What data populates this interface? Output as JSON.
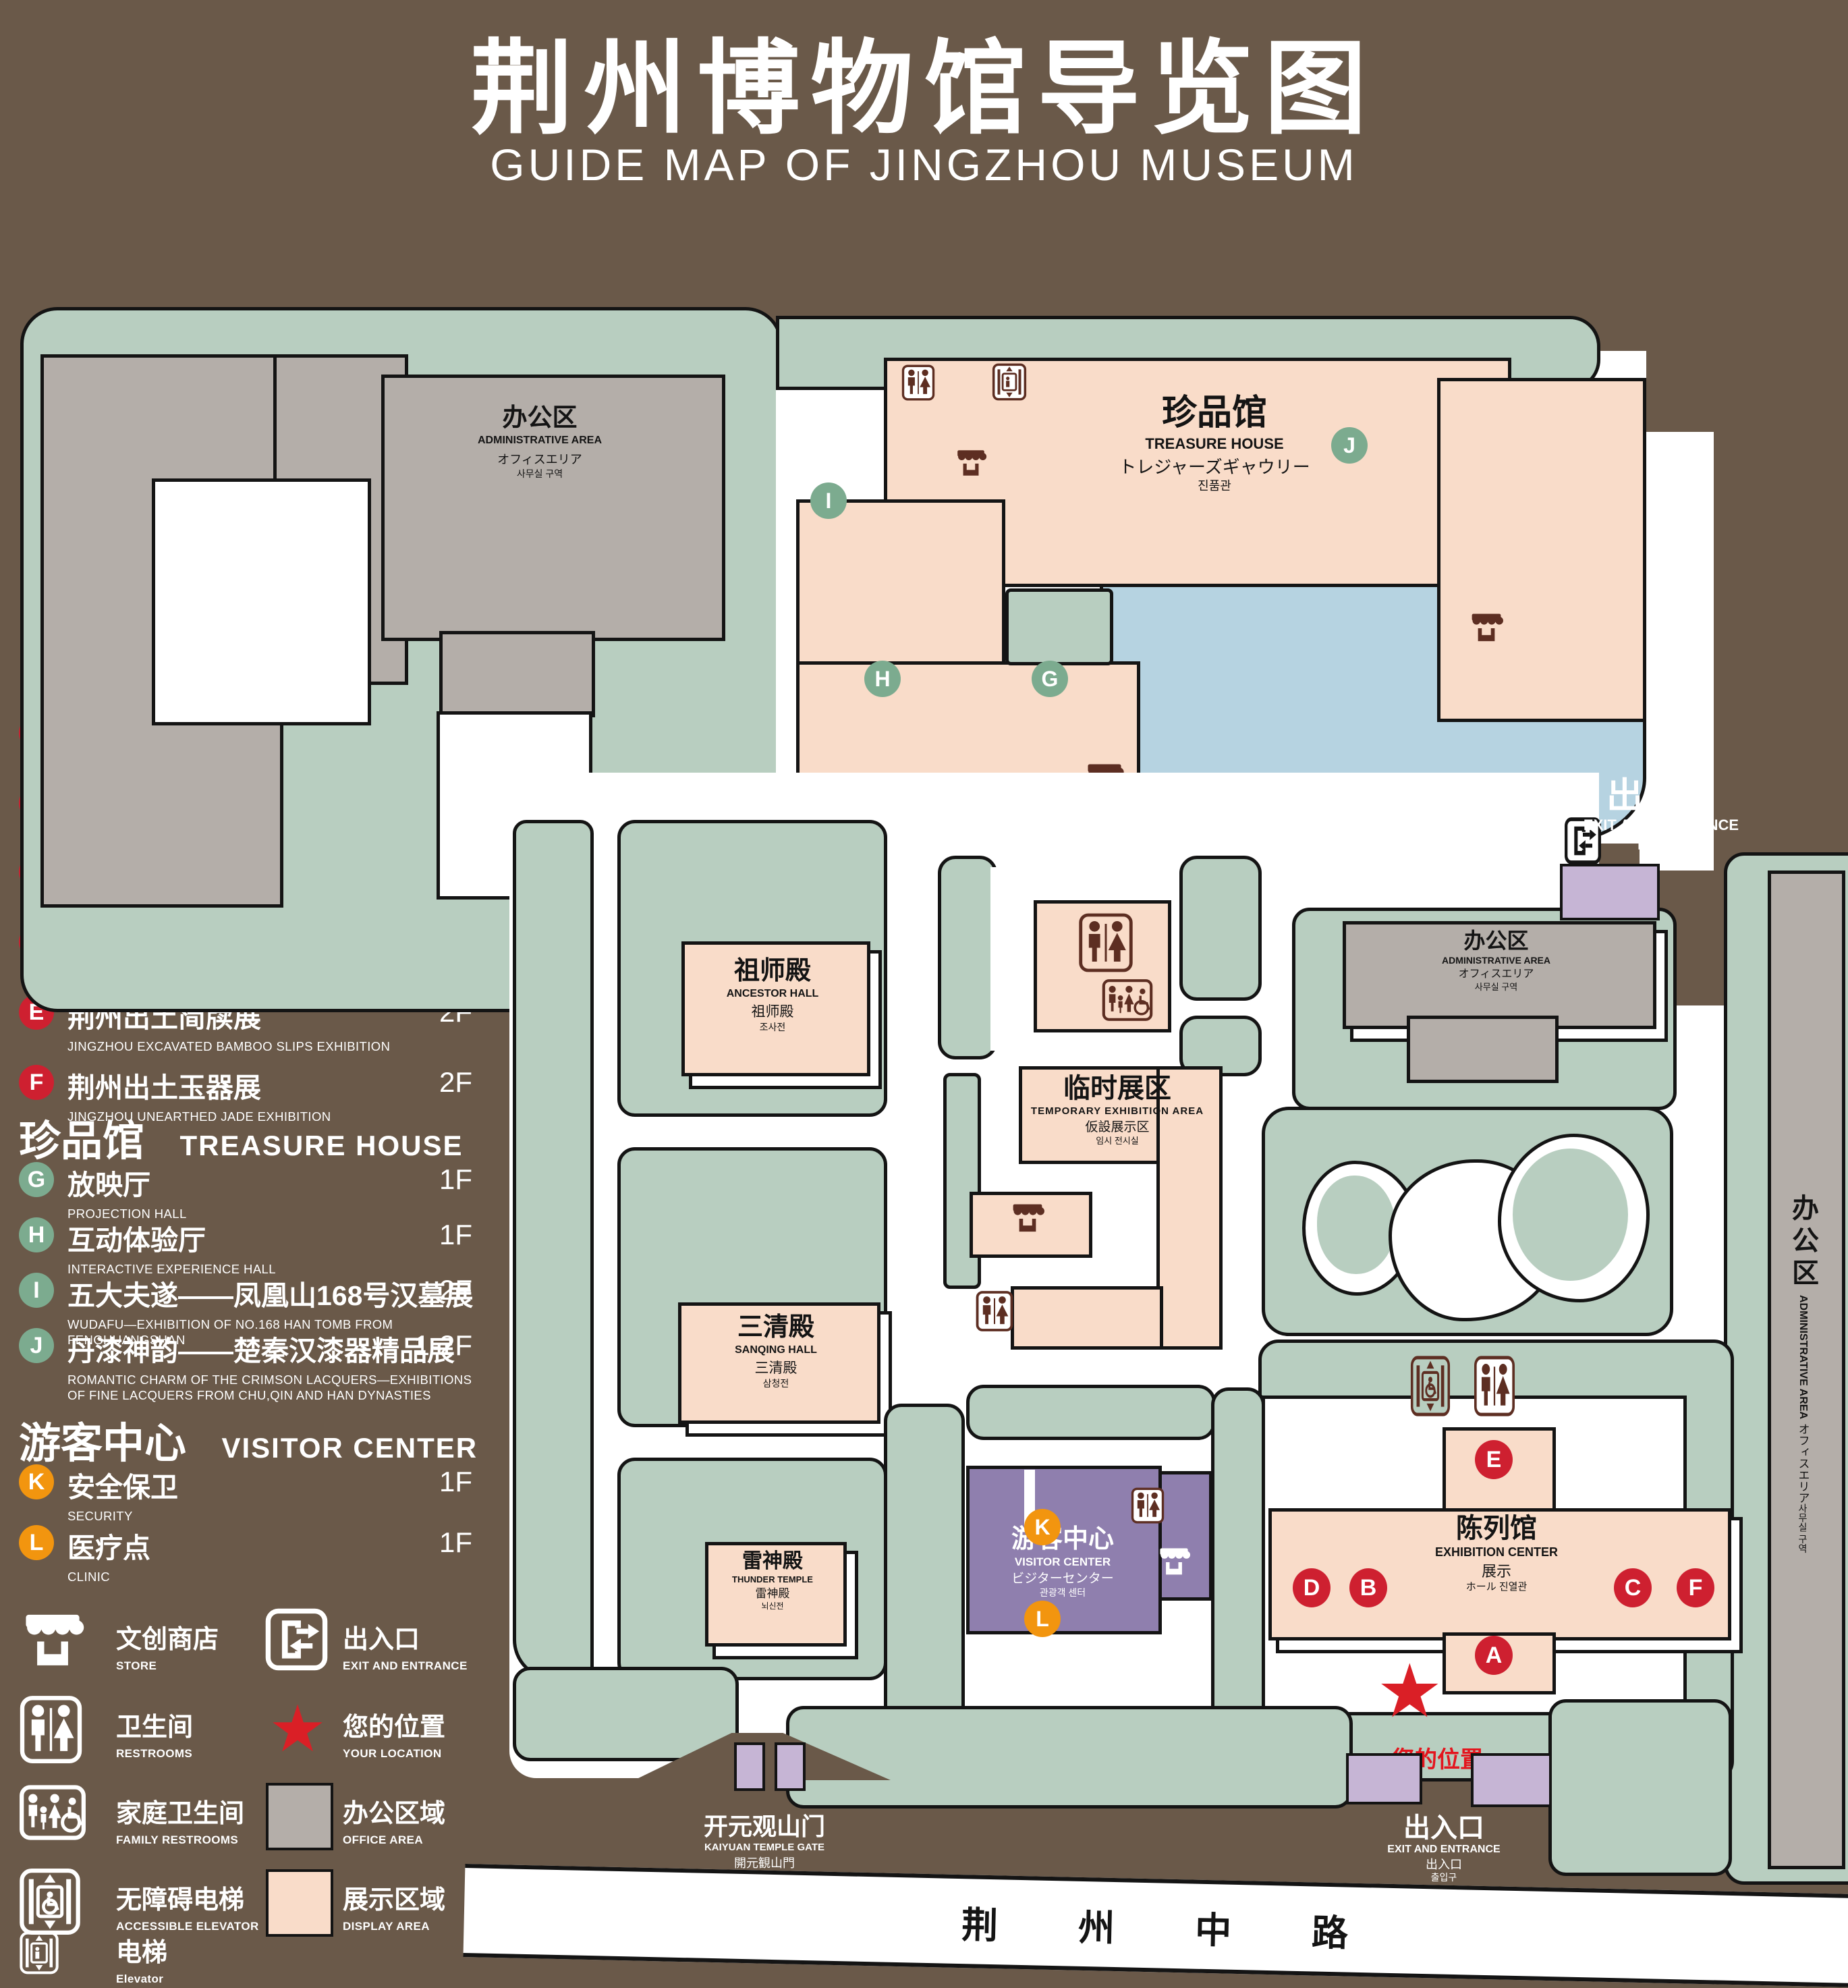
{
  "title": {
    "zh": "荆州博物馆导览图",
    "en": "GUIDE MAP OF JINGZHOU MUSEUM"
  },
  "legend": {
    "sections": [
      {
        "zh": "陈列馆",
        "en": "EXHIBITION CENTER",
        "items": [
          {
            "id": "A",
            "zh": "《火中的凤凰》壁画",
            "en": "THE PHOENIX IN FIRE \"MURAL PAINTING",
            "floor": "1F"
          },
          {
            "id": "B",
            "zh": "荆州出土铜器展",
            "en": "JINGZHOU UNEARTHED BRONZE WARE EXHIBITION",
            "floor": "1F"
          },
          {
            "id": "C",
            "zh": "江汉平原原始文化展",
            "en": "JIANGHAN PLAIN PRIMITIVE CULTURE EXHIBITION",
            "floor": "1F"
          },
          {
            "id": "D",
            "zh": "荆州出土瓷器展",
            "en": "JINGZHOU UNEARTHED PORCELAIN EXHIBITIONE",
            "floor": "2F"
          },
          {
            "id": "E",
            "zh": "荆州出土简牍展",
            "en": "JINGZHOU EXCAVATED BAMBOO SLIPS EXHIBITION",
            "floor": "2F"
          },
          {
            "id": "F",
            "zh": "荆州出土玉器展",
            "en": "JINGZHOU UNEARTHED JADE EXHIBITION",
            "floor": "2F"
          }
        ]
      },
      {
        "zh": "珍品馆",
        "en": "TREASURE HOUSE",
        "items": [
          {
            "id": "G",
            "zh": "放映厅",
            "en": "PROJECTION HALL",
            "floor": "1F"
          },
          {
            "id": "H",
            "zh": "互动体验厅",
            "en": "INTERACTIVE EXPERIENCE HALL",
            "floor": "1F"
          },
          {
            "id": "I",
            "zh": "五大夫遂——凤凰山168号汉墓展",
            "en": "WUDAFU—EXHIBITION OF NO.168 HAN TOMB FROM FENGHUANGSHAN",
            "floor": "2F"
          },
          {
            "id": "J",
            "zh": "丹漆神韵——楚秦汉漆器精品展",
            "en": "ROMANTIC CHARM OF THE CRIMSON LACQUERS—EXHIBITIONS OF FINE LACQUERS FROM CHU,QIN AND HAN DYNASTIES",
            "floor": "1-2F"
          }
        ]
      },
      {
        "zh": "游客中心",
        "en": "VISITOR CENTER",
        "items": [
          {
            "id": "K",
            "zh": "安全保卫",
            "en": "SECURITY",
            "floor": "1F"
          },
          {
            "id": "L",
            "zh": "医疗点",
            "en": "CLINIC",
            "floor": "1F"
          }
        ]
      }
    ],
    "symbols": {
      "store": {
        "zh": "文创商店",
        "en": "STORE"
      },
      "exit": {
        "zh": "出入口",
        "en": "EXIT AND ENTRANCE"
      },
      "restroom": {
        "zh": "卫生间",
        "en": "RESTROOMS"
      },
      "location": {
        "zh": "您的位置",
        "en": "YOUR LOCATION"
      },
      "family": {
        "zh": "家庭卫生间",
        "en": "FAMILY RESTROOMS"
      },
      "office": {
        "zh": "办公区域",
        "en": "OFFICE AREA"
      },
      "accessible": {
        "zh": "无障碍电梯",
        "en": "ACCESSIBLE ELEVATOR"
      },
      "display": {
        "zh": "展示区域",
        "en": "DISPLAY AREA"
      },
      "elevator": {
        "zh": "电梯",
        "en": "Elevator"
      }
    }
  },
  "map": {
    "admin": {
      "zh": "办公区",
      "en": "ADMINISTRATIVE AREA",
      "jp": "オフィスエリア",
      "kr": "사무실 구역"
    },
    "treasure": {
      "zh": "珍品馆",
      "en": "TREASURE HOUSE",
      "jp": "トレジャーズギャウリー",
      "kr": "진품관"
    },
    "ancestor": {
      "zh": "祖师殿",
      "en": "ANCESTOR HALL",
      "zh2": "祖师殿",
      "kr": "조사전"
    },
    "sanqing": {
      "zh": "三清殿",
      "en": "SANQING HALL",
      "zh2": "三清殿",
      "kr": "삼청전"
    },
    "thunder": {
      "zh": "雷神殿",
      "en": "THUNDER TEMPLE",
      "zh2": "雷神殿",
      "kr": "뇌신전"
    },
    "temporary": {
      "zh": "临时展区",
      "en": "TEMPORARY EXHIBITION AREA",
      "jp": "仮設展示区",
      "kr": "임시 전시실"
    },
    "visitor": {
      "zh": "游客中心",
      "en": "VISITOR CENTER",
      "jp": "ビジターセンター",
      "kr": "관광객 센터"
    },
    "exhibition": {
      "zh": "陈列馆",
      "en": "EXHIBITION CENTER",
      "zh2": "展示",
      "kr2": "ホール 진열관"
    },
    "gate": {
      "zh": "开元观山门",
      "en": "KAIYUAN TEMPLE GATE",
      "jp": "開元観山門",
      "kr": "산문을 열다"
    },
    "exit": {
      "zh": "出入口",
      "en": "EXIT AND ENTRANCE",
      "zh2": "出入口",
      "kr": "출입구"
    },
    "your_location": "您的位置",
    "road": "荆 州 中 路",
    "badges": {
      "A": "A",
      "B": "B",
      "C": "C",
      "D": "D",
      "E": "E",
      "F": "F",
      "G": "G",
      "H": "H",
      "I": "I",
      "J": "J",
      "K": "K",
      "L": "L"
    }
  },
  "colors": {
    "background": "#6a5949",
    "park_green": "#b8cec0",
    "display_pink": "#f9dcc9",
    "office_gray": "#b4aea9",
    "lake_blue": "#b6d3e1",
    "visitor_purple": "#8f7fae",
    "entrance_purple": "#c6b5d5",
    "badge_red": "#ce2030",
    "badge_green": "#7cab8f",
    "badge_orange": "#f2950f",
    "icon_maroon": "#5d2e22",
    "location_red": "#da1f26"
  }
}
